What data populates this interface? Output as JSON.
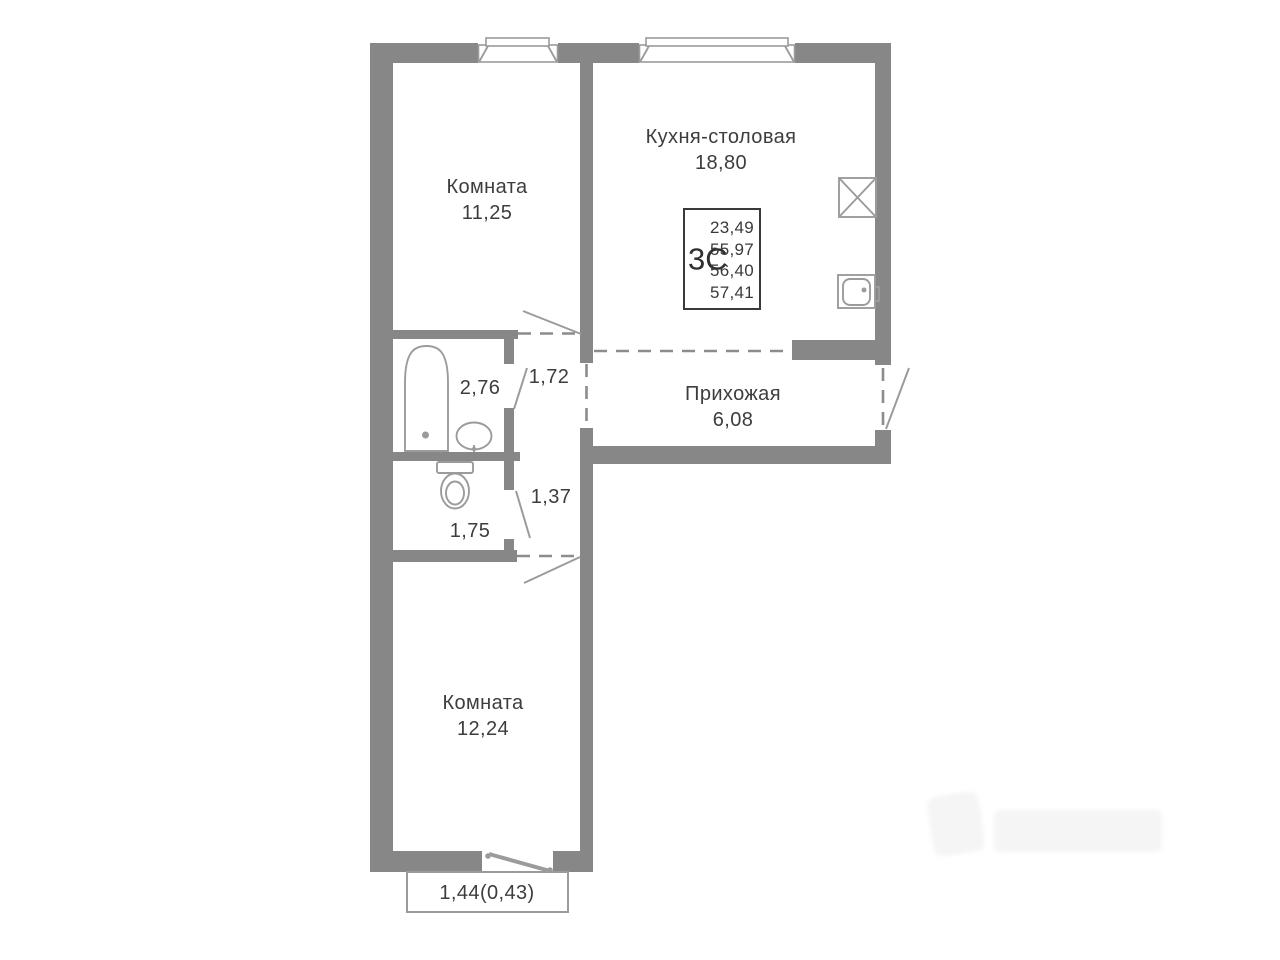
{
  "plan": {
    "unit_card": {
      "type": "3С",
      "areas": [
        "23,49",
        "55,97",
        "56,40",
        "57,41"
      ]
    },
    "rooms": [
      {
        "name": "Комната",
        "area": "11,25"
      },
      {
        "name": "Кухня-столовая",
        "area": "18,80"
      },
      {
        "name": "Прихожая",
        "area": "6,08"
      },
      {
        "name": "",
        "area": "2,76"
      },
      {
        "name": "",
        "area": "1,72"
      },
      {
        "name": "",
        "area": "1,37"
      },
      {
        "name": "",
        "area": "1,75"
      },
      {
        "name": "Комната",
        "area": "12,24"
      }
    ],
    "balcony": {
      "area": "1,44(0,43)"
    },
    "colors": {
      "wall": "#878787",
      "fixture_line": "#9b9b9b",
      "dashed_line": "#8c8c8c",
      "text": "#3d3d3d",
      "unit_card_border": "#3a3a3a",
      "background": "#ffffff"
    }
  }
}
